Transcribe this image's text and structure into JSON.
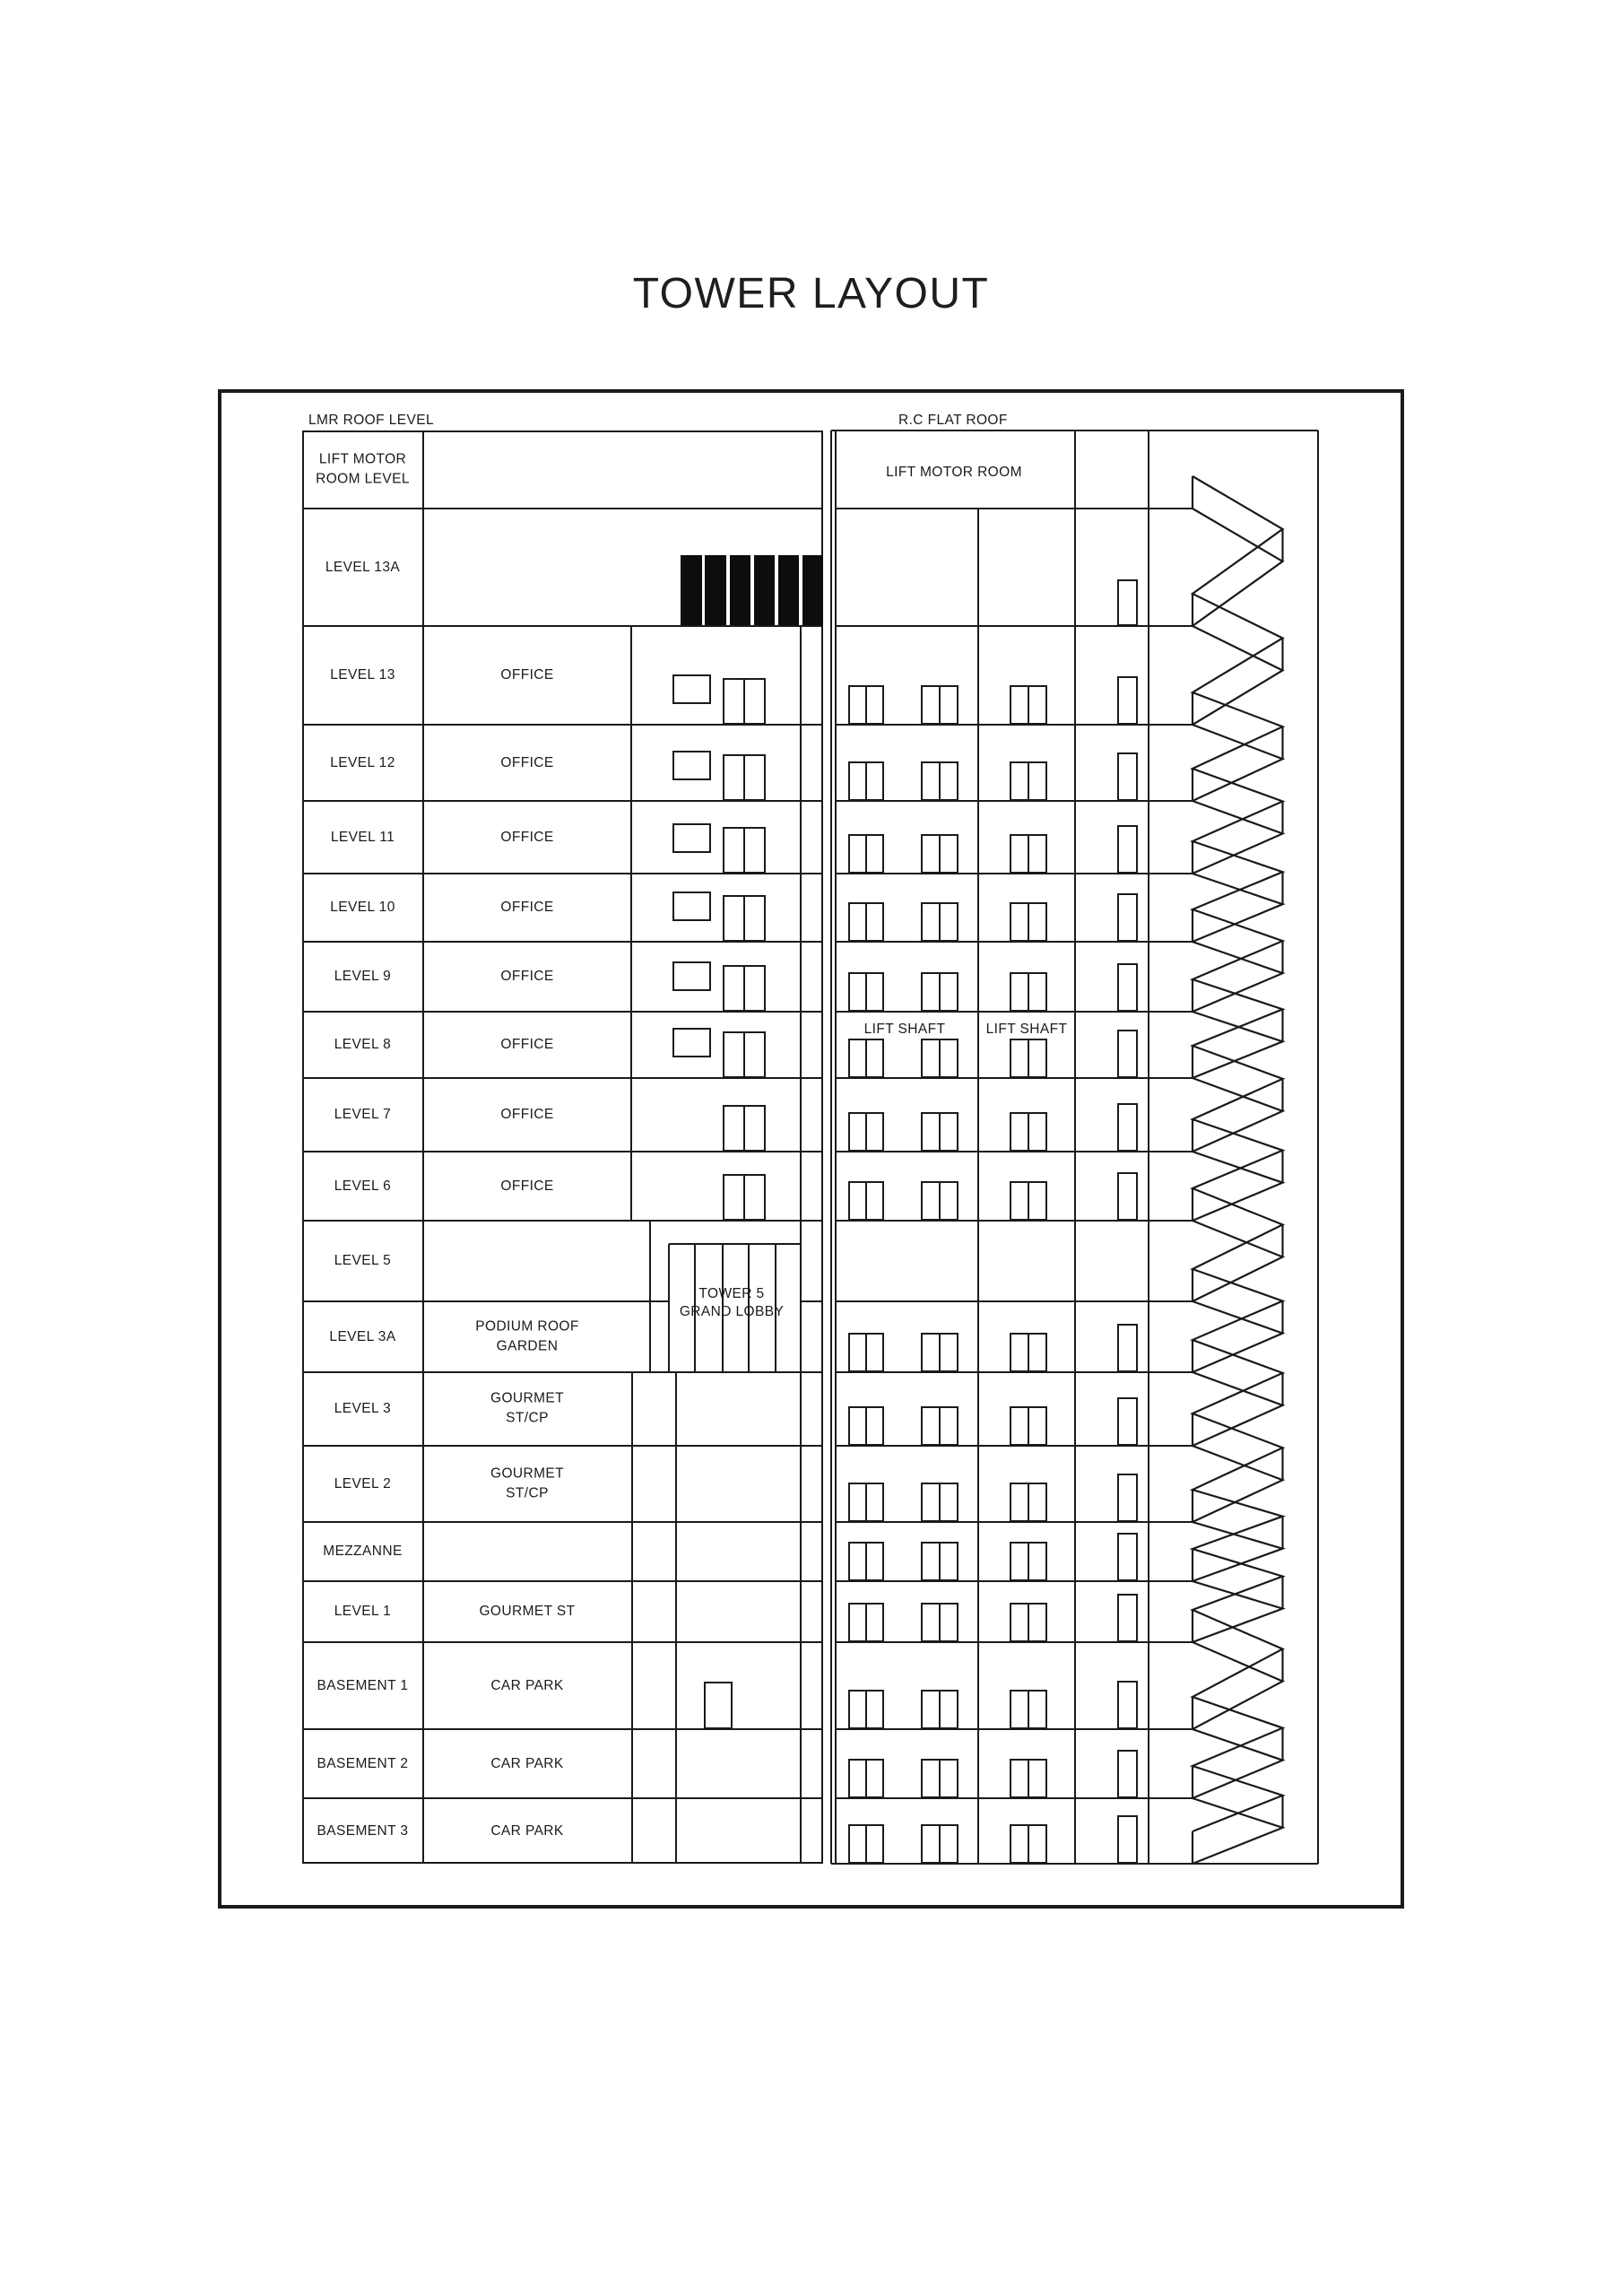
{
  "title": "TOWER LAYOUT",
  "labels": {
    "left_roof": "LMR ROOF LEVEL",
    "right_roof": "R.C FLAT ROOF",
    "lift_motor_room": "LIFT MOTOR ROOM",
    "lift_shaft_left": "LIFT SHAFT",
    "lift_shaft_right": "LIFT SHAFT",
    "lobby_line1": "TOWER 5",
    "lobby_line2": "GRAND LOBBY"
  },
  "floors": [
    {
      "level": "LIFT MOTOR ROOM LEVEL",
      "use": ""
    },
    {
      "level": "LEVEL 13A",
      "use": ""
    },
    {
      "level": "LEVEL 13",
      "use": "OFFICE"
    },
    {
      "level": "LEVEL 12",
      "use": "OFFICE"
    },
    {
      "level": "LEVEL 11",
      "use": "OFFICE"
    },
    {
      "level": "LEVEL 10",
      "use": "OFFICE"
    },
    {
      "level": "LEVEL 9",
      "use": "OFFICE"
    },
    {
      "level": "LEVEL 8",
      "use": "OFFICE"
    },
    {
      "level": "LEVEL 7",
      "use": "OFFICE"
    },
    {
      "level": "LEVEL 6",
      "use": "OFFICE"
    },
    {
      "level": "LEVEL 5",
      "use": ""
    },
    {
      "level": "LEVEL 3A",
      "use": "PODIUM ROOF GARDEN"
    },
    {
      "level": "LEVEL 3",
      "use": "GOURMET ST/CP"
    },
    {
      "level": "LEVEL 2",
      "use": "GOURMET ST/CP"
    },
    {
      "level": "MEZZANNE",
      "use": ""
    },
    {
      "level": "LEVEL 1",
      "use": "GOURMET ST"
    },
    {
      "level": "BASEMENT 1",
      "use": "CAR PARK"
    },
    {
      "level": "BASEMENT 2",
      "use": "CAR PARK"
    },
    {
      "level": "BASEMENT 3",
      "use": "CAR PARK"
    }
  ],
  "colors": {
    "line": "#1a1a1a",
    "text": "#1b1b1b",
    "solid_fill": "#0d0d0d",
    "background": "#ffffff"
  }
}
